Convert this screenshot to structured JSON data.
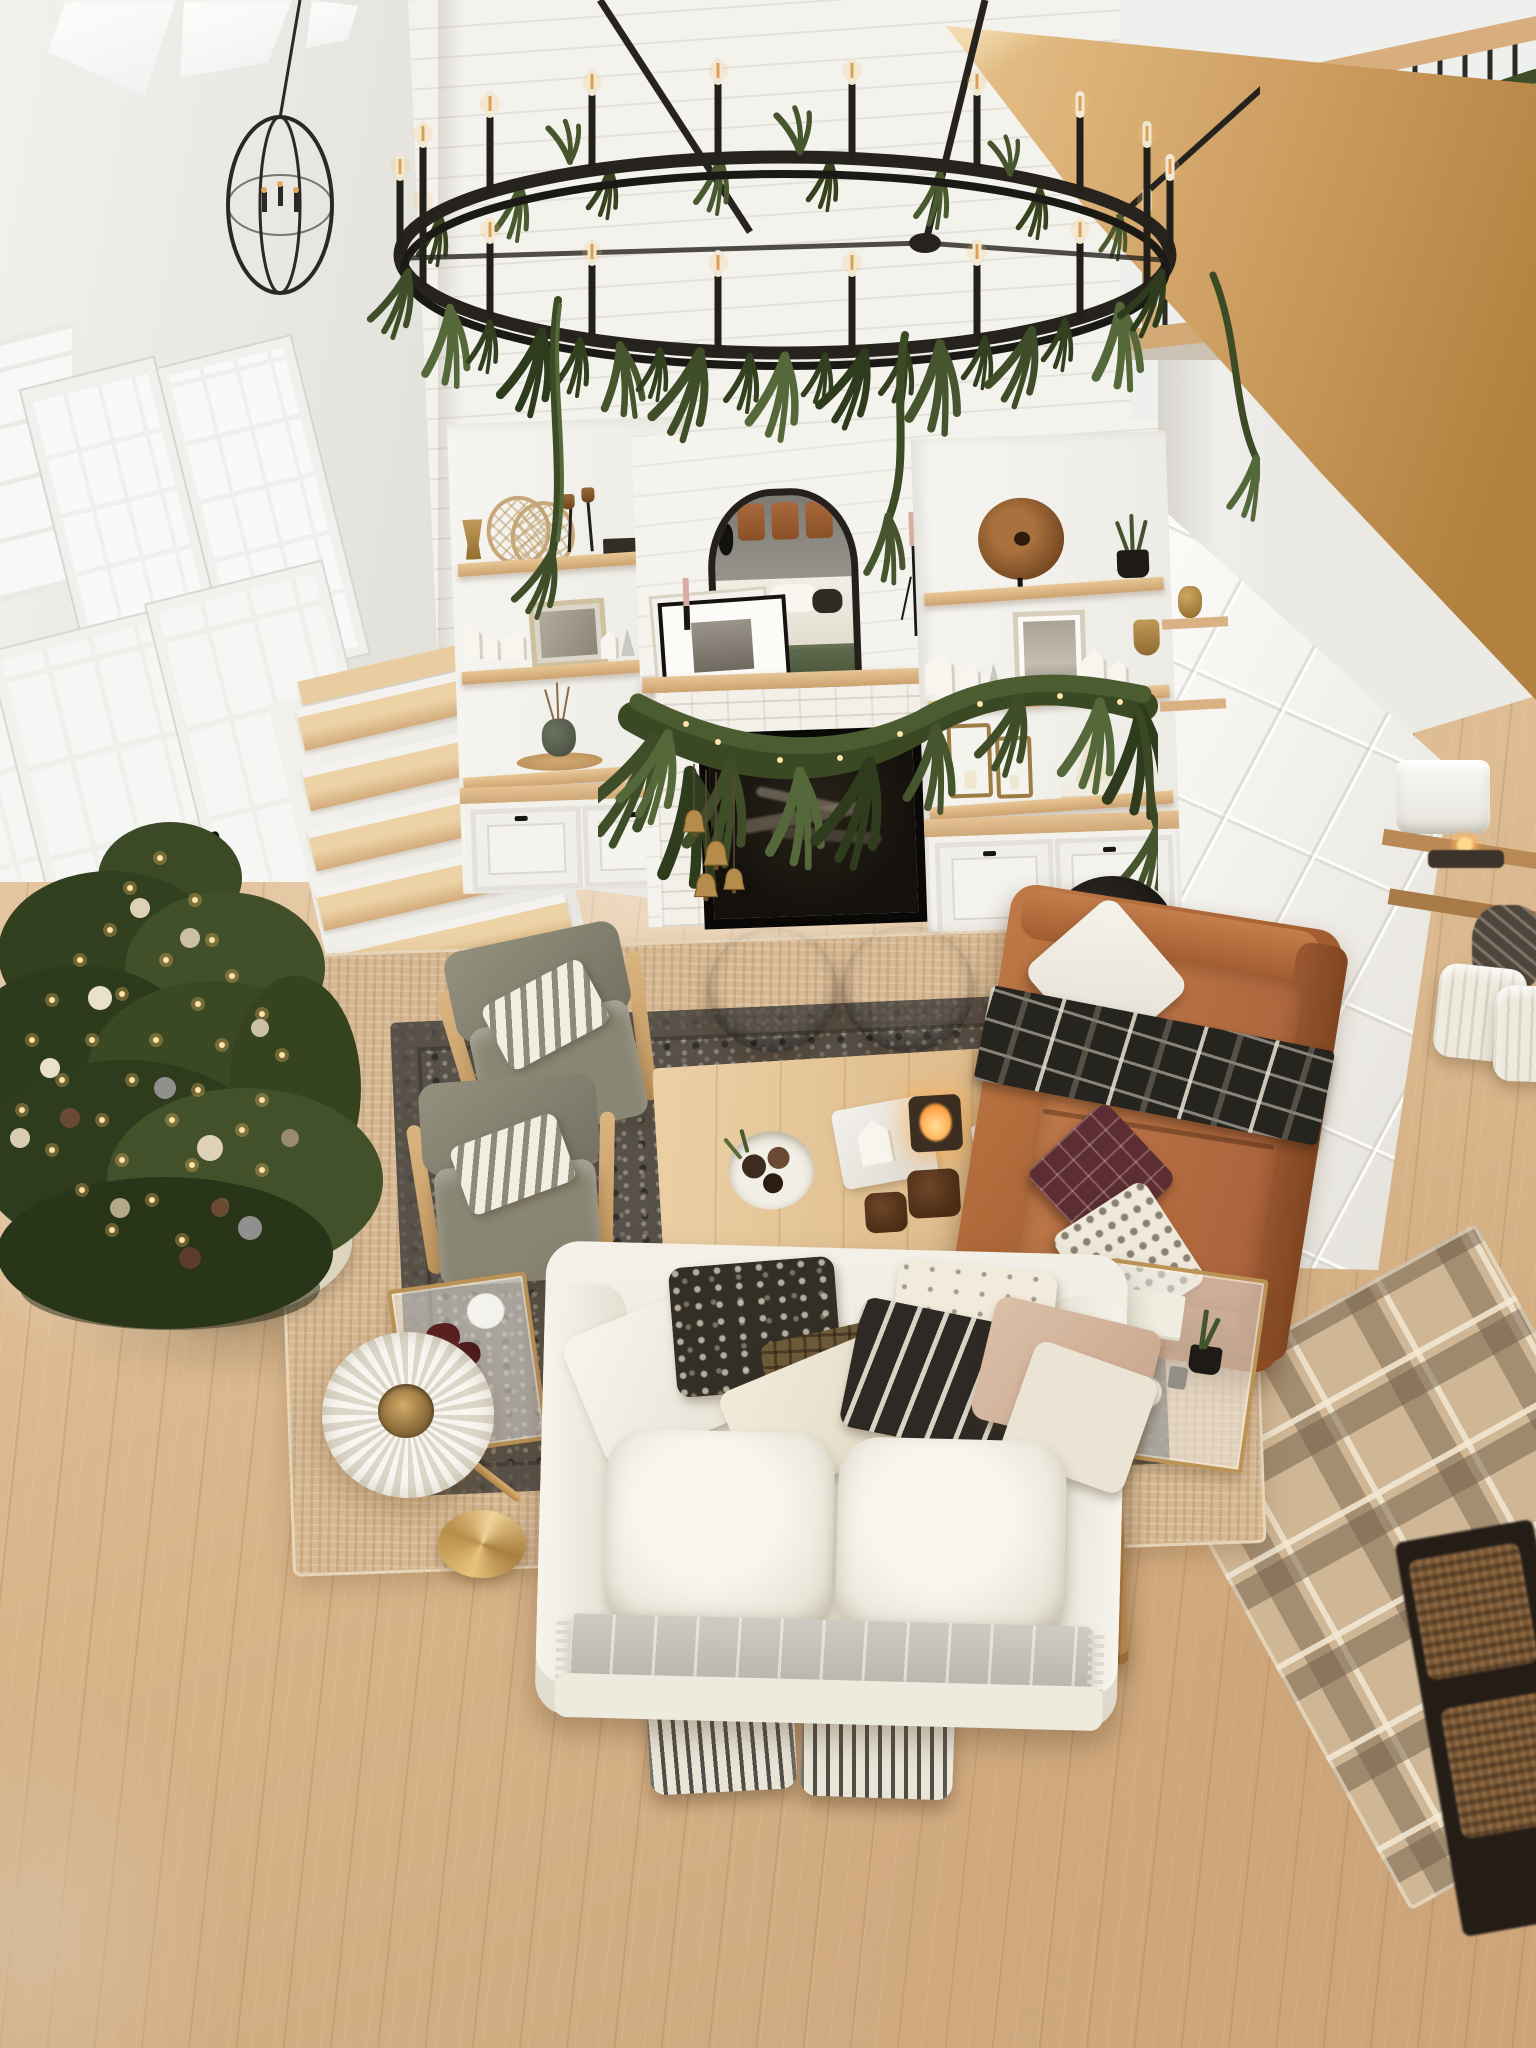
{
  "scene": {
    "caption": "Aerial view from a second-floor loft of a modern farmhouse great room decorated for Christmas. A huge black iron ring chandelier with candelabra bulbs, wrapped in Norfolk-pine garland, hangs before a two-story white shiplap fireplace wall with oak floating shelves, white shaker cabinets, an arched black mirror and a garland-draped mantel with brass bells. A lit Christmas tree stands beside white French doors at left; an oak staircase climbs behind the built-ins. The seating area below layers a charcoal vintage rug over a jute rug with a white slipcovered sofa, a cognac leather sofa with a black plaid throw, two gray lounge chairs, chocolate poufs, an oak coffee table and console styled with pinecones, candles and greenery. At right, a garland-swagged oak loft railing with black spindles, a board-and-batten entry wall, a plaid rug and basket storage complete the view over white-oak floors.",
    "view": "top-down diagonal from loft",
    "theme": "Christmas holiday decor, modern farmhouse",
    "palette": {
      "wall_white": "#f0efeb",
      "shiplap_white": "#f4f2ed",
      "floor_oak_light": "#dcbb95",
      "floor_oak_shadow": "#cda67c",
      "shelf_wood": "#d9b183",
      "beam_wood": "#cf9f63",
      "garland_green_dark": "#2f3b1d",
      "garland_green_mid": "#4a5a30",
      "chandelier_iron": "#26231e",
      "leather_cognac": "#a35c2f",
      "sofa_cream": "#f1eee6",
      "rug_jute": "#d6b893",
      "rug_charcoal": "#57514a",
      "rug_plaid_tan": "#cfb795",
      "pouf_brown": "#3b2a1f",
      "brass": "#bb9355",
      "taper_candle_pink": "#d9aca3",
      "string_light_warm": "#ffe2a4"
    },
    "architecture": {
      "left": "tall white wall, clerestory windows, double-hung windows, French patio doors with black handles",
      "center": "floor-to-ceiling white shiplap fireplace wall, white brick surround, black firebox with logs, oak floating shelves over white shaker cabinets, oak staircase at left of built-ins",
      "right": "white oak loft beam and railing with black metal spindles, white board-and-batten pony wall at entry",
      "floor": "white oak plank flooring"
    },
    "lighting": [
      {
        "name": "ring-chandelier",
        "desc": "oversized black iron ring chandelier, 18 candle bulbs, wrapped in pine garland"
      },
      {
        "name": "orb-pendant",
        "desc": "small black metal orb chandelier near windows"
      },
      {
        "name": "pleated-floor-lamp",
        "desc": "cream pleated shade with brass stem and gold disc base"
      },
      {
        "name": "entry-lamp",
        "desc": "white drum-shade lamp on entry console with lit candle"
      },
      {
        "name": "tree-lights",
        "desc": "warm white string lights on Christmas tree"
      }
    ],
    "furniture": [
      "white slipcovered sofa with layered pillows (white, black floral, brown check, cream, black stripe with tassels, blush) and gray wool throw",
      "cognac leather sofa with white pillow, black plaid throw, burgundy windowpane pillow, cream dotted pillow",
      "two gray upholstered lounge chairs with light wood arms and striped lumbar pillows",
      "two chocolate brown round poufs",
      "white oak rectangular coffee table",
      "oak console table behind sofa",
      "two black-and-cream ticking stripe ottomans",
      "black round side table with cream bowl of ornaments",
      "two brass-and-glass side tables",
      "entry console with woven baskets and white poufs",
      "dark wood entry table with woven baskets"
    ],
    "decor": [
      "Christmas tree with warm lights, cream/silver/brown ornaments and white tree skirt",
      "pine garland on chandelier, mantel, railing and console",
      "brass bells hanging from mantel garland",
      "arched black ornate mirror reflecting the seating area",
      "leaning framed black-and-white art and landscape prints",
      "pink taper candles in black holders",
      "white ceramic village houses and cream paper trees",
      "rattan snowshoes, brass urn, bells on stands, wood disc sculpture",
      "brass lanterns with candles",
      "dried branches in stone vase on wood tray",
      "bowl of ornaments with greenery, white house and lit candle on marble tray, velvet pumpkins, books with brass shell on coffee table",
      "black vase on white books, open design book, black bowl of pinecones on console"
    ],
    "textiles": [
      "natural jute area rug",
      "charcoal vintage-pattern rug",
      "brown plaid entry rug",
      "gray wool blanket",
      "black plaid blanket"
    ]
  }
}
